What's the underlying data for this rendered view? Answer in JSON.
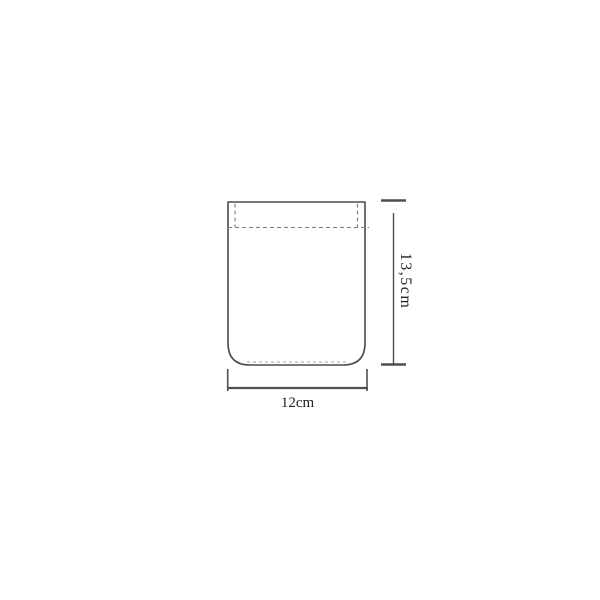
{
  "diagram": {
    "width_label": "12cm",
    "height_label": "13,5cm"
  },
  "colors": {
    "background": "#ffffff",
    "outline": "#4b4b4b",
    "stitch": "#7d7d7d",
    "stitch_light": "#a0a0a0",
    "dimension": "#4f4f4f",
    "label": "#222222"
  }
}
